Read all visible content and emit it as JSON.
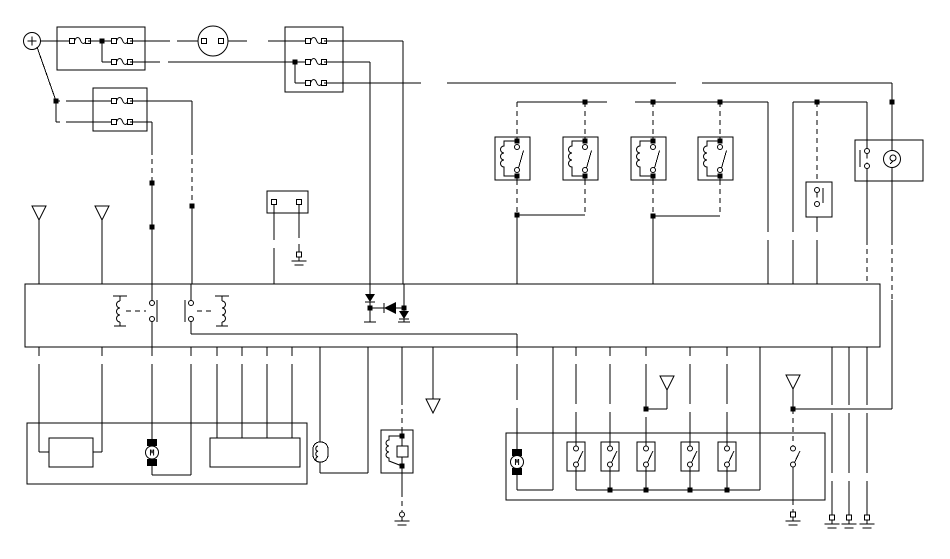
{
  "diagram": {
    "background": "#ffffff",
    "line_color": "#000000",
    "motor_left_label": "M",
    "motor_right_label": "M",
    "symbols": [
      "battery",
      "fuse",
      "ignition-switch",
      "relay",
      "relay-coil",
      "switch-contact",
      "diode",
      "motor",
      "lamp",
      "ground",
      "connector-arrow",
      "control-unit-band",
      "solenoid-valve",
      "sensor-coil",
      "junction-dot",
      "terminal-square"
    ]
  }
}
